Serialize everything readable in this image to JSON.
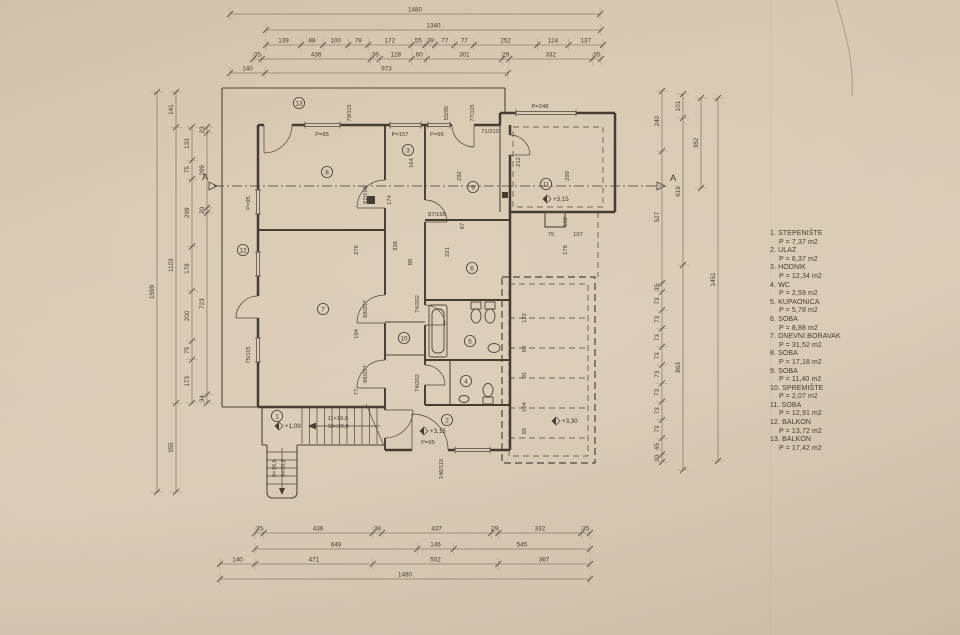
{
  "legend": {
    "items": [
      {
        "line1": "1. STEPENIŠTE",
        "line2": "P = 7,37 m2"
      },
      {
        "line1": "2. ULAZ",
        "line2": "P = 6,37 m2"
      },
      {
        "line1": "3. HODNIK",
        "line2": "P = 12,34 m2"
      },
      {
        "line1": "4. WC",
        "line2": "P = 2,59 m2"
      },
      {
        "line1": "5. KUPAONICA",
        "line2": "P = 5,78 m2"
      },
      {
        "line1": "6. SOBA",
        "line2": "P = 8,88 m2"
      },
      {
        "line1": "7. DNEVNI BORAVAK",
        "line2": "P = 31,52 m2"
      },
      {
        "line1": "8. SOBA",
        "line2": "P = 17,18 m2"
      },
      {
        "line1": "9. SOBA",
        "line2": "P = 11,40 m2"
      },
      {
        "line1": "10. SPREMIŠTE",
        "line2": "P = 2,07 m2"
      },
      {
        "line1": "11. SOBA",
        "line2": "P = 12,91 m2"
      },
      {
        "line1": "12. BALKON",
        "line2": "P = 13,72 m2"
      },
      {
        "line1": "13. BALKON",
        "line2": "P = 17,42 m2"
      }
    ]
  },
  "section": {
    "letter": "A"
  },
  "chains": [
    {
      "o": "h",
      "y": 14,
      "a": 230,
      "b": 600,
      "v": [
        "1480"
      ]
    },
    {
      "o": "h",
      "y": 30,
      "a": 266,
      "b": 601,
      "v": [
        "1340"
      ]
    },
    {
      "o": "h",
      "y": 45,
      "a": 266,
      "b": 603,
      "v": [
        "139",
        "88",
        "100",
        "79",
        "172",
        "55",
        "39",
        "77",
        "77",
        "252",
        "124",
        "137"
      ]
    },
    {
      "o": "h",
      "y": 59,
      "a": 253,
      "b": 601,
      "v": [
        "35",
        "436",
        "36",
        "128",
        "60",
        "301",
        "29",
        "332",
        "35"
      ]
    },
    {
      "o": "h",
      "y": 73,
      "a": 230,
      "b": 508,
      "v": [
        "140",
        "973"
      ]
    },
    {
      "o": "h",
      "y": 533,
      "a": 255,
      "b": 590,
      "v": [
        "35",
        "436",
        "38",
        "437",
        "29",
        "332",
        "35"
      ]
    },
    {
      "o": "h",
      "y": 549,
      "a": 255,
      "b": 590,
      "v": [
        "649",
        "146",
        "545"
      ]
    },
    {
      "o": "h",
      "y": 564,
      "a": 220,
      "b": 590,
      "v": [
        "140",
        "471",
        "502",
        "367"
      ]
    },
    {
      "o": "h",
      "y": 579,
      "a": 220,
      "b": 590,
      "v": [
        "1480"
      ]
    },
    {
      "o": "v",
      "x": 157,
      "a": 92,
      "b": 492,
      "v": [
        "1599"
      ]
    },
    {
      "o": "v",
      "x": 176,
      "a": 92,
      "b": 492,
      "v": [
        "141",
        "1103",
        "355"
      ]
    },
    {
      "o": "v",
      "x": 192,
      "a": 127,
      "b": 403,
      "v": [
        "133",
        "75",
        "269",
        "178",
        "200",
        "75",
        "173"
      ]
    },
    {
      "o": "v",
      "x": 207,
      "a": 127,
      "b": 403,
      "v": [
        "23",
        "299",
        "20",
        "723",
        "34"
      ]
    },
    {
      "o": "v",
      "x": 662,
      "a": 91,
      "b": 462,
      "v": [
        "240",
        "527",
        "35",
        "73",
        "73",
        "73",
        "73",
        "73",
        "73",
        "73",
        "73",
        "65",
        "30"
      ]
    },
    {
      "o": "v",
      "x": 683,
      "a": 94,
      "b": 470,
      "v": [
        "101",
        "619",
        "863"
      ]
    },
    {
      "o": "v",
      "x": 701,
      "a": 98,
      "b": 188,
      "v": [
        "362"
      ]
    },
    {
      "o": "v",
      "x": 718,
      "a": 98,
      "b": 461,
      "v": [
        "1451"
      ]
    }
  ],
  "labels": [
    {
      "t": "P=95",
      "x": 322,
      "y": 136,
      "r": 0
    },
    {
      "t": "P=157",
      "x": 400,
      "y": 136,
      "r": 0
    },
    {
      "t": "P=95",
      "x": 437,
      "y": 136,
      "r": 0
    },
    {
      "t": "P=248",
      "x": 540,
      "y": 108,
      "r": 0
    },
    {
      "t": "P=95",
      "x": 428,
      "y": 444,
      "r": 0
    },
    {
      "t": "P=95",
      "x": 250,
      "y": 203,
      "r": 1
    },
    {
      "t": "75/115",
      "x": 250,
      "y": 355,
      "r": 1
    },
    {
      "t": "79/115",
      "x": 351,
      "y": 113,
      "r": 1
    },
    {
      "t": "55/95",
      "x": 448,
      "y": 113,
      "r": 1
    },
    {
      "t": "77/115",
      "x": 474,
      "y": 113,
      "r": 1
    },
    {
      "t": "174",
      "x": 391,
      "y": 200,
      "r": 1
    },
    {
      "t": "164",
      "x": 413,
      "y": 163,
      "r": 1
    },
    {
      "t": "292",
      "x": 461,
      "y": 176,
      "r": 1
    },
    {
      "t": "212",
      "x": 520,
      "y": 162,
      "r": 1
    },
    {
      "t": "299",
      "x": 569,
      "y": 176,
      "r": 1
    },
    {
      "t": "87",
      "x": 464,
      "y": 226,
      "r": 1
    },
    {
      "t": "150",
      "x": 567,
      "y": 222,
      "r": 1
    },
    {
      "t": "178",
      "x": 567,
      "y": 250,
      "r": 1
    },
    {
      "t": "122",
      "x": 526,
      "y": 318,
      "r": 1
    },
    {
      "t": "88",
      "x": 526,
      "y": 349,
      "r": 1
    },
    {
      "t": "91",
      "x": 526,
      "y": 375,
      "r": 1
    },
    {
      "t": "104",
      "x": 526,
      "y": 407,
      "r": 1
    },
    {
      "t": "65",
      "x": 526,
      "y": 431,
      "r": 1
    },
    {
      "t": "276",
      "x": 358,
      "y": 250,
      "r": 1
    },
    {
      "t": "338",
      "x": 397,
      "y": 246,
      "r": 1
    },
    {
      "t": "221",
      "x": 449,
      "y": 252,
      "r": 1
    },
    {
      "t": "194",
      "x": 358,
      "y": 334,
      "r": 1
    },
    {
      "t": "88",
      "x": 412,
      "y": 262,
      "r": 1
    },
    {
      "t": "77",
      "x": 358,
      "y": 392,
      "r": 1
    },
    {
      "t": "75",
      "x": 551,
      "y": 236,
      "r": 0
    },
    {
      "t": "107",
      "x": 578,
      "y": 236,
      "r": 0
    },
    {
      "t": "82/196",
      "x": 367,
      "y": 195,
      "r": 1
    },
    {
      "t": "88/207",
      "x": 367,
      "y": 309,
      "r": 1
    },
    {
      "t": "88/207",
      "x": 367,
      "y": 374,
      "r": 1
    },
    {
      "t": "87/196",
      "x": 437,
      "y": 216,
      "r": 0
    },
    {
      "t": "74/202",
      "x": 419,
      "y": 304,
      "r": 1
    },
    {
      "t": "74/202",
      "x": 419,
      "y": 383,
      "r": 1
    },
    {
      "t": "71/210",
      "x": 490,
      "y": 133,
      "r": 0
    },
    {
      "t": "146/115",
      "x": 443,
      "y": 469,
      "r": 1
    },
    {
      "t": "11×16,6",
      "x": 338,
      "y": 420,
      "r": 0
    },
    {
      "t": "10×30,8",
      "x": 338,
      "y": 428,
      "r": 0
    },
    {
      "t": "8×16,6",
      "x": 276,
      "y": 468,
      "r": 1
    },
    {
      "t": "8×30,8",
      "x": 285,
      "y": 468,
      "r": 1
    }
  ],
  "rooms": [
    {
      "n": "13",
      "x": 299,
      "y": 103
    },
    {
      "n": "12",
      "x": 243,
      "y": 250
    },
    {
      "n": "8",
      "x": 327,
      "y": 172
    },
    {
      "n": "3",
      "x": 408,
      "y": 150
    },
    {
      "n": "9",
      "x": 473,
      "y": 187
    },
    {
      "n": "11",
      "x": 546,
      "y": 184
    },
    {
      "n": "6",
      "x": 472,
      "y": 268
    },
    {
      "n": "7",
      "x": 323,
      "y": 309
    },
    {
      "n": "10",
      "x": 404,
      "y": 338
    },
    {
      "n": "5",
      "x": 470,
      "y": 341
    },
    {
      "n": "4",
      "x": 466,
      "y": 381
    },
    {
      "n": "1",
      "x": 277,
      "y": 416
    },
    {
      "n": "2",
      "x": 447,
      "y": 420
    }
  ],
  "levels": [
    {
      "t": "+3,15",
      "x": 547,
      "y": 199
    },
    {
      "t": "+3,15",
      "x": 424,
      "y": 431
    },
    {
      "t": "+3,30",
      "x": 556,
      "y": 421
    },
    {
      "t": "+1,09",
      "x": 279,
      "y": 426
    }
  ]
}
